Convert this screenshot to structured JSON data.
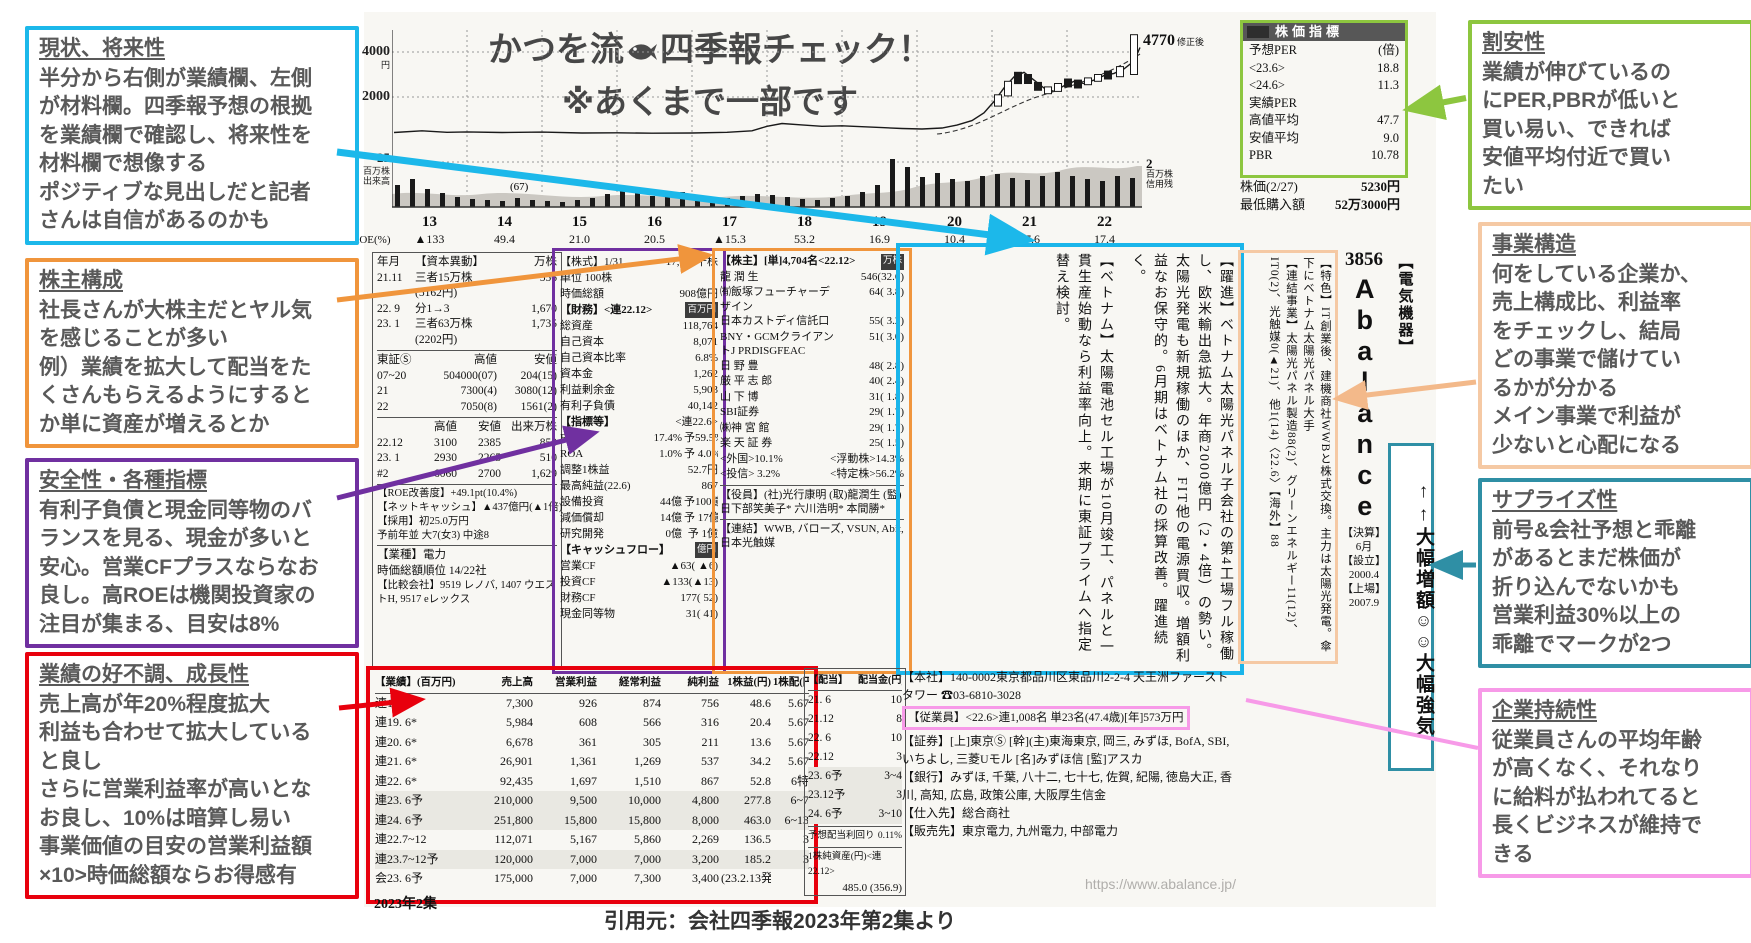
{
  "title": {
    "line1_pre": "かつを流",
    "line1_post": "四季報チェック！",
    "line2": "※あくまで一部です"
  },
  "footer": {
    "source": "引用元：会社四季報2023年第2集より",
    "edition": "2023年2集",
    "url": "https://www.abalance.jp/"
  },
  "annotations": {
    "left": [
      {
        "heading": "現状、将来性",
        "color": "#1cb8ea",
        "body": "半分から右側が業績欄、左側\nが材料欄。四季報予想の根拠\nを業績欄で確認し、将来性を\n材料欄で想像する\nポジティブな見出しだと記者\nさんは自信があるのかも"
      },
      {
        "heading": "株主構成",
        "color": "#f0953c",
        "body": "社長さんが大株主だとヤル気\nを感じることが多い\n例）業績を拡大して配当をた\nくさんもらえるようにすると\nか単に資産が増えるとか"
      },
      {
        "heading": "安全性・各種指標",
        "color": "#7030a0",
        "body": "有利子負債と現金同等物のバ\nランスを見る、現金が多いと\n安心。営業CFプラスならなお\n良し。高ROEは機関投資家の\n注目が集まる、目安は8%"
      },
      {
        "heading": "業績の好不調、成長性",
        "color": "#e8000d",
        "body": "売上高が年20%程度拡大\n利益も合わせて拡大している\nと良し\nさらに営業利益率が高いとな\nお良し、10%は暗算し易い\n事業価値の目安の営業利益額\n×10>時価総額ならお得感有"
      }
    ],
    "right": [
      {
        "heading": "割安性",
        "color": "#8dc63f",
        "body": "業績が伸びているの\nにPER,PBRが低いと\n買い易い、できれば\n安値平均付近で買い\nたい"
      },
      {
        "heading": "事業構造",
        "color": "#f5c9a4",
        "body": "何をしている企業か、\n売上構成比、利益率\nをチェックし、結局\nどの事業で儲けてい\nるかが分かる\nメイン事業で利益が\n少ないと心配になる"
      },
      {
        "heading": "サプライズ性",
        "color": "#2f8fa5",
        "body": "前号&会社予想と乖離\nがあるとまだ株価が\n折り込んでないかも\n営業利益30%以上の\n乖離でマークが2つ"
      },
      {
        "heading": "企業持続性",
        "color": "#f79ae8",
        "body": "従業員さんの平均年齢\nが高くなく、それなり\nに給料が払われてると\n長くビジネスが維持で\nきる"
      }
    ]
  },
  "chart": {
    "y_tick1": "4000",
    "y_tick1_unit": "円",
    "y_tick2": "2000",
    "vol_tick": "25",
    "vol_unit": "百万株",
    "vol_label": "出来高",
    "credit_tick": "2",
    "credit_unit": "百万株",
    "credit_label": "信用残",
    "peak": "4770",
    "peak_note": "修正後",
    "note": "(67)",
    "years": [
      "13",
      "14",
      "15",
      "16",
      "17",
      "18",
      "19",
      "20",
      "21",
      "22"
    ],
    "roe_label": "ROE(%)",
    "roe": [
      "▲133",
      "49.4",
      "21.0",
      "20.5",
      "▲15.3",
      "53.2",
      "16.9",
      "10.4",
      "17.6",
      "17.4"
    ],
    "price_profile": [
      [
        2,
        420
      ],
      [
        30,
        500
      ],
      [
        55,
        430
      ],
      [
        75,
        450
      ],
      [
        110,
        420
      ],
      [
        150,
        440
      ],
      [
        190,
        400
      ],
      [
        225,
        410
      ],
      [
        260,
        390
      ],
      [
        300,
        400
      ],
      [
        335,
        430
      ],
      [
        360,
        500
      ],
      [
        375,
        700
      ],
      [
        390,
        820
      ],
      [
        410,
        760
      ],
      [
        430,
        700
      ],
      [
        450,
        720
      ],
      [
        470,
        680
      ],
      [
        490,
        640
      ],
      [
        510,
        600
      ],
      [
        530,
        580
      ],
      [
        550,
        620
      ],
      [
        565,
        750
      ],
      [
        580,
        950
      ],
      [
        592,
        1300
      ],
      [
        602,
        1800
      ],
      [
        612,
        2400
      ],
      [
        622,
        2900
      ],
      [
        632,
        3100
      ],
      [
        642,
        2750
      ],
      [
        652,
        2400
      ],
      [
        662,
        2250
      ],
      [
        672,
        2500
      ],
      [
        682,
        2700
      ],
      [
        692,
        2600
      ],
      [
        702,
        2750
      ],
      [
        712,
        2950
      ],
      [
        722,
        3050
      ],
      [
        732,
        3250
      ],
      [
        742,
        3600
      ],
      [
        748,
        4200
      ]
    ],
    "volume_profile": [
      22,
      28,
      18,
      14,
      10,
      8,
      7,
      6,
      9,
      7,
      6,
      5,
      7,
      9,
      13,
      17,
      15,
      11,
      13,
      15,
      12,
      10,
      9,
      11,
      13,
      12,
      10,
      8,
      7,
      9,
      11,
      15,
      22,
      48,
      40,
      30,
      34,
      28,
      26,
      31,
      33,
      29,
      27,
      31,
      35,
      31,
      28,
      26,
      31,
      29
    ],
    "candles": [
      [
        606,
        2100,
        1600,
        1
      ],
      [
        616,
        2700,
        2050,
        1
      ],
      [
        626,
        3100,
        2600,
        0
      ],
      [
        636,
        3000,
        2600,
        0
      ],
      [
        646,
        2650,
        2300,
        0
      ],
      [
        656,
        2450,
        2150,
        1
      ],
      [
        666,
        2600,
        2250,
        1
      ],
      [
        676,
        2800,
        2450,
        0
      ],
      [
        686,
        2750,
        2400,
        0
      ],
      [
        696,
        2850,
        2550,
        1
      ],
      [
        706,
        3000,
        2700,
        1
      ],
      [
        716,
        3150,
        2800,
        0
      ],
      [
        728,
        3350,
        2900,
        1
      ],
      [
        742,
        4770,
        3000,
        1
      ]
    ]
  },
  "box_colors": {
    "shares": "#7030a0",
    "holders": "#f0953c",
    "material": "#1ab5ea",
    "feature": "#f5c9a4",
    "performance": "#e8000d",
    "indicators": "#8dc63f",
    "employees": "#f79ae8",
    "surprise": "#2f8fa5"
  },
  "shikiho": {
    "capital": {
      "table": [
        [
          "年月",
          "【資本異動】",
          "万株"
        ],
        [
          "21.11",
          "三者15万株",
          "556"
        ],
        [
          "",
          "(5162円)",
          ""
        ],
        [
          "22. 9",
          "分1→3",
          "1,670"
        ],
        [
          "23. 1",
          "三者63万株",
          "1,735"
        ],
        [
          "",
          "(2202円)",
          ""
        ]
      ],
      "market": [
        [
          "東証Ⓢ",
          "高値",
          "安値"
        ],
        [
          "07~20",
          "504000(07)",
          "204(15)"
        ],
        [
          "21",
          "7300(4)",
          "3080(12)"
        ],
        [
          "22",
          "7050(8)",
          "1561(2)"
        ]
      ],
      "monthly": [
        [
          "",
          "高値",
          "安値",
          "出来万株"
        ],
        [
          "22.12",
          "3100",
          "2385",
          "850"
        ],
        [
          "23. 1",
          "2930",
          "2265",
          "510"
        ],
        [
          "#2",
          "6060",
          "2700",
          "1,629"
        ]
      ],
      "notes": [
        "【ROE改善度】+49.1pt(10.4%)",
        "【ネットキャッシュ】▲437億円(▲1倍)",
        "【採用】初25.0万円",
        "予前年並 大7(女3) 中途8"
      ],
      "sector": "【業種】電力",
      "rank": "時価総額順位 14/22社",
      "peers": "【比較会社】9519 レノバ, 1407 ウエストH, 9517 eレックス"
    },
    "shares": {
      "head": [
        [
          "【株式】1/31",
          "17,361千株"
        ],
        [
          "単位 100株",
          ""
        ],
        [
          "時価総額",
          "908億円"
        ]
      ],
      "fin_label": "【財務】<連22.12>",
      "fin_unit": "百万円",
      "fin": [
        [
          "総資産",
          "118,764"
        ],
        [
          "自己資本",
          "8,071"
        ],
        [
          "自己資本比率",
          "6.8%"
        ],
        [
          "資本金",
          "1,262"
        ],
        [
          "利益剰余金",
          "5,903"
        ],
        [
          "有利子負債",
          "40,142"
        ]
      ],
      "ind_label": "【指標等】",
      "ind_unit": "<連22.6>",
      "ind": [
        [
          "ROE",
          "17.4%",
          "予59.5%"
        ],
        [
          "ROA",
          "1.0%",
          "予 4.0%"
        ],
        [
          "調整1株益",
          "",
          "52.7円"
        ],
        [
          "最高純益(22.6)",
          "",
          "867"
        ],
        [
          "設備投資",
          "44億",
          "予100億"
        ],
        [
          "減価償却",
          "14億",
          "予 17億"
        ],
        [
          "研究開発",
          "0億",
          "予  1億"
        ]
      ],
      "cf_label": "【キャッシュフロー】",
      "cf_unit": "億円",
      "cf": [
        [
          "営業CF",
          "▲63( ▲6)"
        ],
        [
          "投資CF",
          "▲133(▲13)"
        ],
        [
          "財務CF",
          "177( 52)"
        ],
        [
          "現金同等物",
          "31( 41)"
        ]
      ]
    },
    "holders": {
      "label": "【株主】[単]4,704名<22.12>",
      "unit": "万株",
      "rows": [
        [
          "龍 潤 生",
          "546(32.6)"
        ],
        [
          "㈲飯塚フューチャーデザイン",
          "64( 3.8)"
        ],
        [
          "日本カストディ信託口",
          "55( 3.2)"
        ],
        [
          "BNY・GCMクライアントJ PRDISGFEAC",
          "51( 3.0)"
        ],
        [
          "日 野  豊",
          "48( 2.8)"
        ],
        [
          "厳 平 志 郎",
          "40( 2.4)"
        ],
        [
          "山 下  博",
          "31( 1.8)"
        ],
        [
          "SBI証券",
          "29( 1.7)"
        ],
        [
          "㈱神 宮 館",
          "29( 1.7)"
        ],
        [
          "楽 天 証 券",
          "25( 1.5)"
        ]
      ],
      "stats": [
        [
          "<外国>10.1%",
          "<浮動株>14.3%"
        ],
        [
          "<投信> 3.2%",
          "<特定株>56.2%"
        ]
      ],
      "officers": "【役員】(社)光行康明 (取)龍潤生 (監)日下部笑美子* 六川浩明* 本間勝*",
      "group": "【連結】WWB, バローズ, VSUN, Abit, 日本光触媒"
    },
    "material": {
      "article1": "【躍進】ベトナム太陽光パネル子会社の第4工場フル稼働し、欧米輸出急拡大。年商2000億円（2・4倍）の勢い。太陽光発電も新規稼働のほか、FIT他の電源買収。増額利益なお保守的。6月期はベトナム社の採算改善。躍進続く。",
      "article2": "【ベトナム】太陽電池セル工場が10月竣工、パネルと一貫生産始動なら利益率向上。来期に東証プライムへ指定替え検討。"
    },
    "feature": {
      "tokushoku": "【特色】IT創業後、建機商社WWBと株式交換。主力は太陽光発電。傘下にベトナム太陽光パネル大手",
      "segments": "【連結事業】太陽光パネル製造88(2)、グリーンエネルギー11(12)、IT0(2)、光触媒0(▲21)、他1(14)〈22.6〉【海外】88"
    },
    "code_strip": {
      "code": "3856",
      "name": "Abalance",
      "settle_label": "【決算】",
      "settle": "6月",
      "founded_label": "【設立】",
      "founded": "2000.4",
      "listed_label": "【上場】",
      "listed": "2007.9"
    },
    "industry": "【電気機器】",
    "surprise": {
      "arrows": "↑↑",
      "label1": "大幅増額",
      "smileys": "☺☺",
      "label2": "大幅強気"
    },
    "indicators": {
      "header": "株価指標",
      "rows": [
        [
          "予想PER",
          "(倍)"
        ],
        [
          "<23.6>",
          "18.8"
        ],
        [
          "<24.6>",
          "11.3"
        ],
        [
          "実績PER",
          ""
        ],
        [
          "高値平均",
          "47.7"
        ],
        [
          "安値平均",
          "9.0"
        ],
        [
          "PBR",
          "10.78"
        ]
      ],
      "price_label": "株価(2/27)",
      "price_value": "5230円",
      "min_label": "最低購入額",
      "min_value": "52万3000円"
    },
    "performance": {
      "table": [
        [
          "【業績】(百万円)",
          "売上高",
          "営業利益",
          "経常利益",
          "純利益",
          "1株益(円)",
          "1株配(円)"
        ],
        [
          "連18. 6*",
          "7,300",
          "926",
          "874",
          "756",
          "48.6",
          "5.67"
        ],
        [
          "連19. 6*",
          "5,984",
          "608",
          "566",
          "316",
          "20.4",
          "5.67"
        ],
        [
          "連20. 6*",
          "6,678",
          "361",
          "305",
          "211",
          "13.6",
          "5.67"
        ],
        [
          "連21. 6*",
          "26,901",
          "1,361",
          "1,269",
          "537",
          "34.2",
          "5.67"
        ],
        [
          "連22. 6*",
          "92,435",
          "1,697",
          "1,510",
          "867",
          "52.8",
          "6特"
        ],
        [
          "連23. 6予",
          "210,000",
          "9,500",
          "10,000",
          "4,800",
          "277.8",
          "6~7"
        ],
        [
          "連24. 6予",
          "251,800",
          "15,800",
          "15,800",
          "8,000",
          "463.0",
          "6~13"
        ],
        [
          "連22.7~12",
          "112,071",
          "5,167",
          "5,860",
          "2,269",
          "136.5",
          "3"
        ],
        [
          "連23.7~12予",
          "120,000",
          "7,000",
          "7,000",
          "3,200",
          "185.2",
          "3"
        ],
        [
          "会23. 6予",
          "175,000",
          "7,000",
          "7,300",
          "3,400",
          "(23.2.13発表)",
          ""
        ]
      ]
    },
    "dividend": {
      "table": [
        [
          "【配当】",
          "配当金(円)"
        ],
        [
          "21. 6",
          "10"
        ],
        [
          "21.12",
          "8"
        ],
        [
          "22. 6",
          "10"
        ],
        [
          "22.12",
          "3"
        ],
        [
          "23. 6予",
          "3~4"
        ],
        [
          "23.12予",
          "3"
        ],
        [
          "24. 6予",
          "3~10"
        ]
      ],
      "yield_label": "予想配当利回り",
      "yield_value": "0.11%",
      "bps_label": "1株純資産(円)<連22.12>",
      "bps_value": "485.0",
      "bps_prev": "(356.9)"
    },
    "company": {
      "hq": "【本社】140-0002東京都品川区東品川2-2-4 天王洲ファーストタワー ☎03-6810-3028",
      "employees": "【従業員】<22.6>連1,008名 単23名(47.4歳)[年]573万円",
      "securities": "【証券】[上]東京Ⓢ [幹](主)東海東京, 岡三, みずほ, BofA, SBI, いちよし, 三菱Uモル [名]みずほ信 [監]アスカ",
      "banks": "【銀行】みずほ, 千葉, 八十二, 七十七, 佐賀, 紀陽, 徳島大正, 香川, 高知, 広島, 政策公庫, 大阪厚生信金",
      "suppliers": "【仕入先】総合商社",
      "customers": "【販売先】東京電力, 九州電力, 中部電力"
    }
  }
}
